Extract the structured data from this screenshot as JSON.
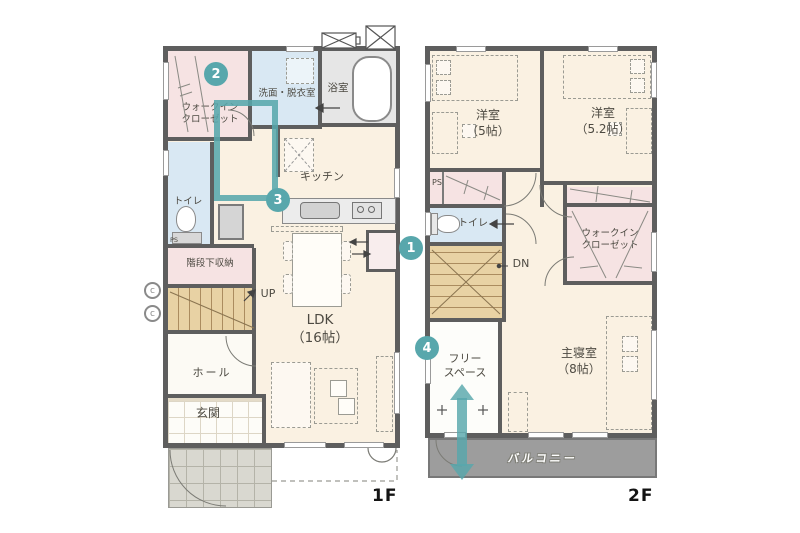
{
  "title": "間取り図",
  "colors": {
    "accent_teal": "#58a7ac",
    "wall": "#5e5e5e",
    "floor_cream": "#faf1e2",
    "closet_pink": "#f6e3e3",
    "wet_blue": "#d9e8f3",
    "stair_tan": "#e8d2a4",
    "balcony_gray": "#9d9d9d"
  },
  "annotations": {
    "badges": [
      "1",
      "2",
      "3",
      "4"
    ]
  },
  "floor1": {
    "label": "1F",
    "walk_in_closet": "ウォークイン\nクローゼット",
    "washroom": "洗面・脱衣室",
    "bath": "浴室",
    "kitchen": "キッチン",
    "toilet": "トイレ",
    "toilet_ps": "PS",
    "under_stair_storage": "階段下収納",
    "up": "UP",
    "hall": "ホール",
    "entrance": "玄関",
    "ldk": "LDK\n（16帖）",
    "meter": "c"
  },
  "floor2": {
    "label": "2F",
    "bedroom1": "洋室\n（5帖）",
    "bedroom2": "洋室\n（5.2帖）",
    "ps": "PS",
    "toilet": "トイレ",
    "down": "DN",
    "walk_in_closet": "ウォークイン\nクローゼット",
    "master_bedroom": "主寝室\n（8帖）",
    "free_space": "フリー\nスペース",
    "balcony": "バルコニー"
  }
}
